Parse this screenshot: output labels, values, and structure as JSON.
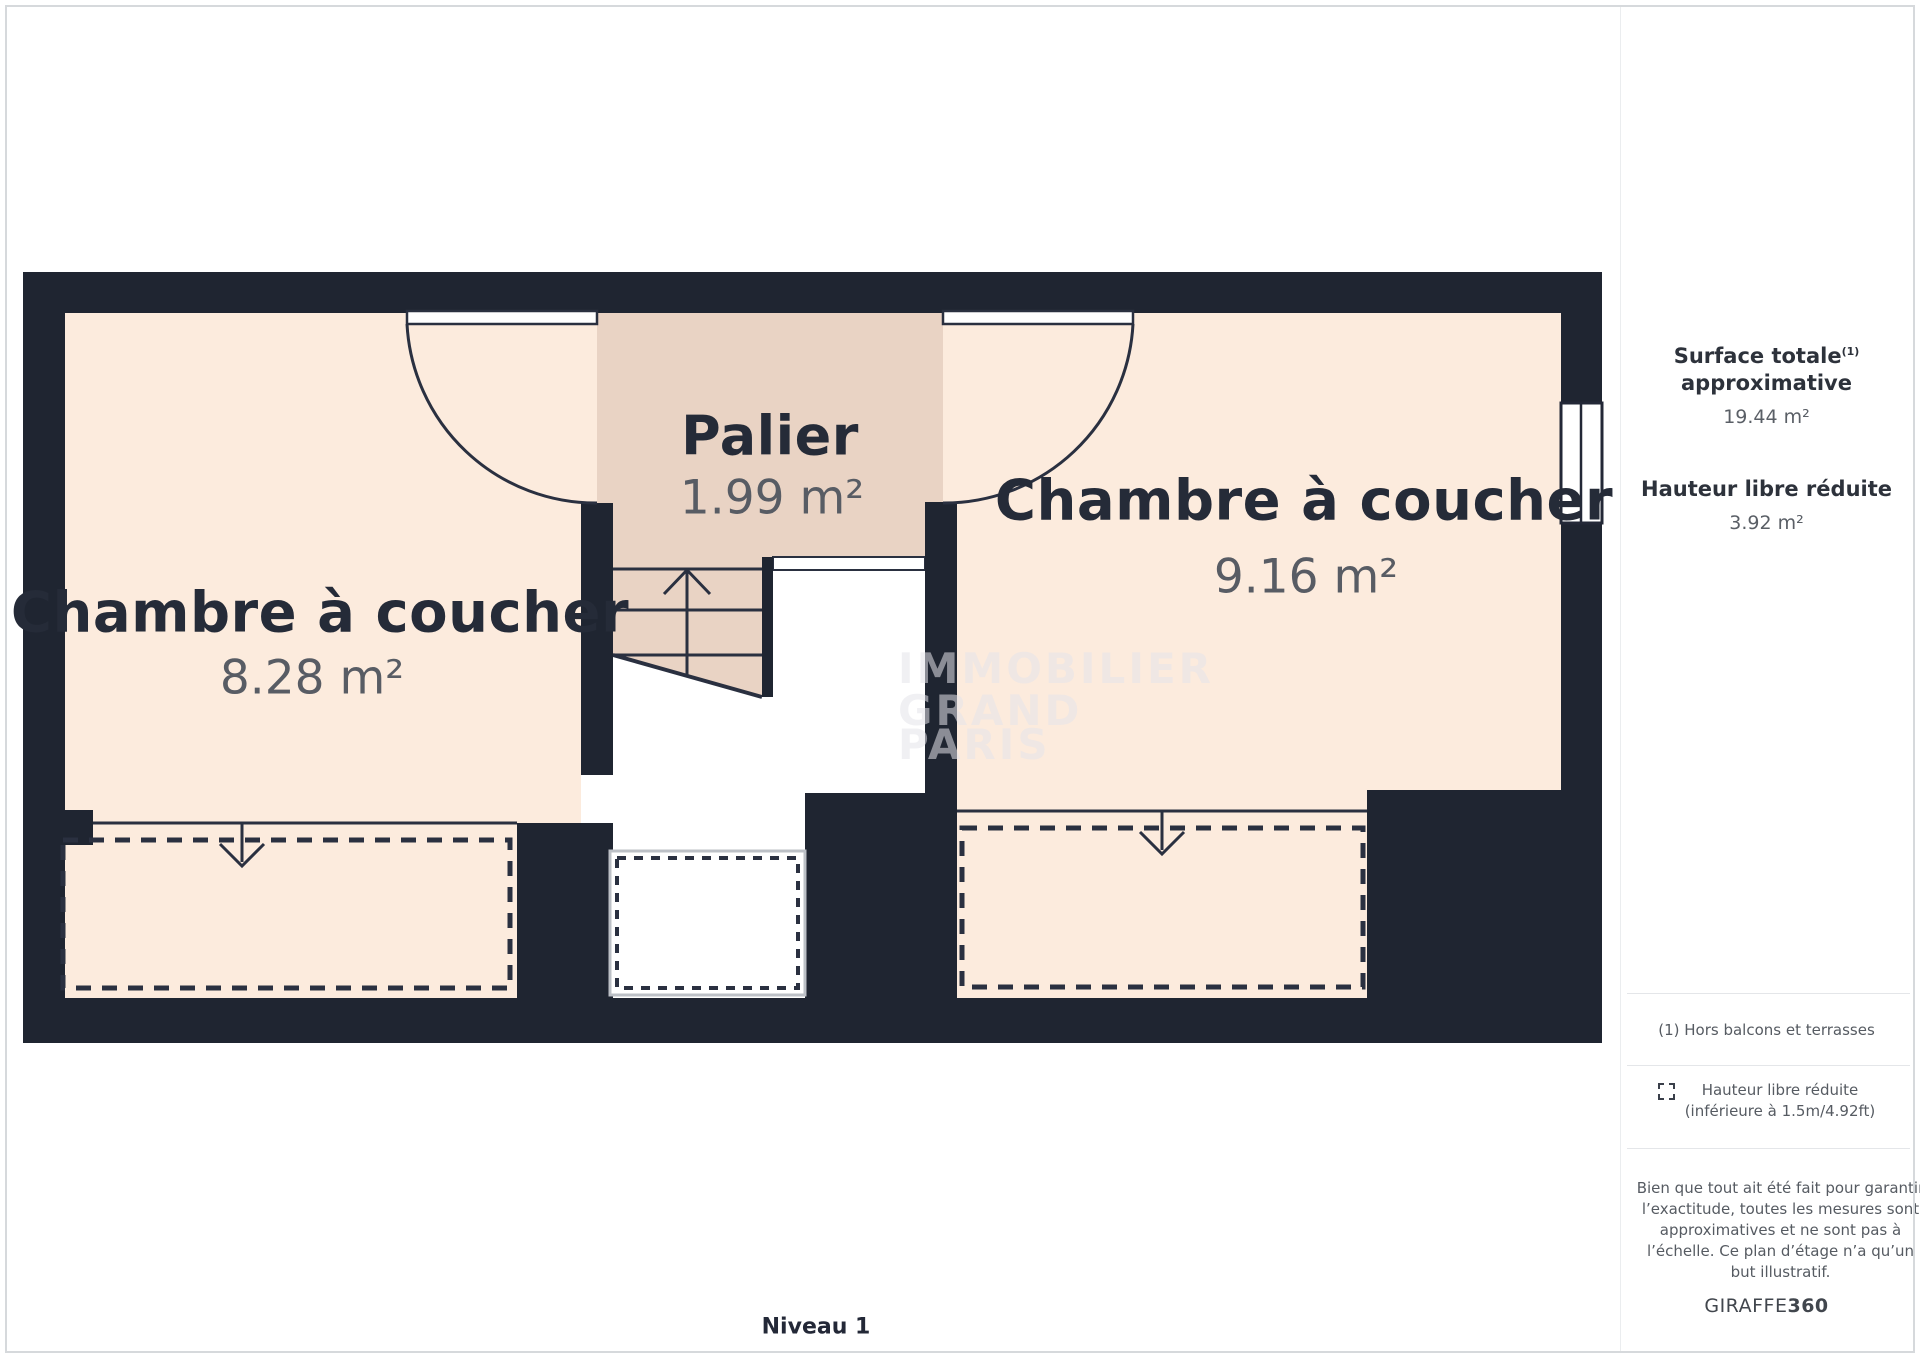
{
  "plan": {
    "level_label": "Niveau 1",
    "room_left": {
      "name": "Chambre à coucher",
      "area": "8.28 m²"
    },
    "room_palier": {
      "name": "Palier",
      "area": "1.99 m²"
    },
    "room_right": {
      "name": "Chambre à coucher",
      "area": "9.16 m²"
    },
    "watermark_lines": [
      "IMMOBILIER",
      "GRAND",
      "PARIS"
    ],
    "colors": {
      "wall": "#1f2531",
      "floor": "#fcebdd",
      "landing_floor": "#e9d3c4",
      "reduced_height_dash": "#2a3040"
    }
  },
  "sidebar": {
    "surface_title": "Surface totale",
    "surface_footnote_mark": "(1)",
    "surface_subtitle": "approximative",
    "surface_value": "19.44 m²",
    "height_title": "Hauteur libre réduite",
    "height_value": "3.92 m²",
    "footnote": "(1) Hors balcons et terrasses",
    "legend_line1": "Hauteur libre réduite",
    "legend_line2": "(inférieure à 1.5m/4.92ft)",
    "disclaimer_lines": [
      "Bien que tout ait été fait pour garantir",
      "l’exactitude, toutes les mesures sont",
      "approximatives et ne sont pas à",
      "l’échelle. Ce plan d’étage n’a qu’un",
      "but illustratif."
    ],
    "brand_name": "GIRAFFE",
    "brand_suffix": "360"
  }
}
